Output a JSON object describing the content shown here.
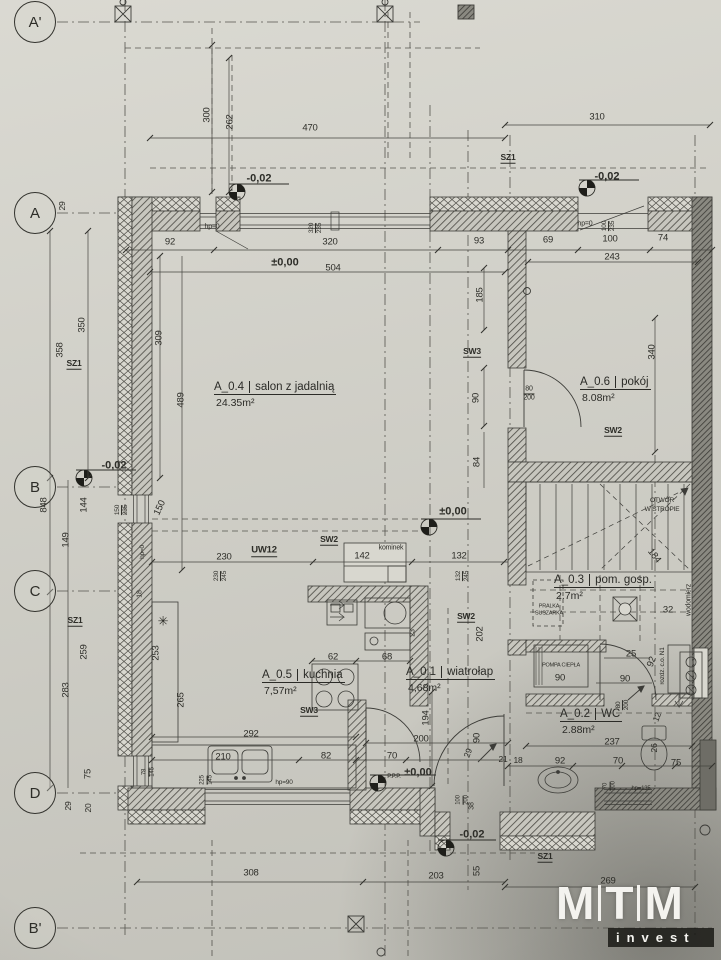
{
  "colors": {
    "paper": "#d8d7cf",
    "line": "#3c3c38",
    "dark_wall": "#6e6d66",
    "logo": "#f4f3ef"
  },
  "logo": {
    "letters": [
      "M",
      "T",
      "M"
    ],
    "sub": "invest"
  },
  "axes": [
    {
      "label": "A'",
      "x": 35,
      "y": 22
    },
    {
      "label": "A",
      "x": 35,
      "y": 213
    },
    {
      "label": "B",
      "x": 35,
      "y": 487
    },
    {
      "label": "C",
      "x": 35,
      "y": 591
    },
    {
      "label": "D",
      "x": 35,
      "y": 793
    },
    {
      "label": "B'",
      "x": 35,
      "y": 928
    }
  ],
  "rooms": [
    {
      "id": "A_0.4",
      "name": "salon z jadalnią",
      "area": "24.35m²",
      "x": 214,
      "y": 381
    },
    {
      "id": "A_0.6",
      "name": "pokój",
      "area": "8.08m²",
      "x": 580,
      "y": 376
    },
    {
      "id": "A_0.5",
      "name": "kuchnia",
      "area": "7,57m²",
      "x": 262,
      "y": 669
    },
    {
      "id": "A_0.1",
      "name": "wiatrołap",
      "area": "4,68m²",
      "x": 406,
      "y": 666
    },
    {
      "id": "A_0.3",
      "name": "pom. gosp.",
      "area": "2.7m²",
      "x": 554,
      "y": 574
    },
    {
      "id": "A_0.2",
      "name": "WC",
      "area": "2.88m²",
      "x": 560,
      "y": 708
    }
  ],
  "labels": [
    {
      "t": "300",
      "x": 207,
      "y": 115,
      "r": -90
    },
    {
      "t": "262",
      "x": 230,
      "y": 122,
      "r": -90
    },
    {
      "t": "470",
      "x": 310,
      "y": 128
    },
    {
      "t": "310",
      "x": 597,
      "y": 117
    },
    {
      "t": "SZ1",
      "x": 508,
      "y": 158,
      "u": 1
    },
    {
      "t": "-0,02",
      "x": 259,
      "y": 179,
      "b": 1,
      "n": "elevation-label"
    },
    {
      "t": "-0,02",
      "x": 607,
      "y": 177,
      "b": 1,
      "n": "elevation-label"
    },
    {
      "t": "hp=0",
      "x": 212,
      "y": 227,
      "s": 7
    },
    {
      "t": "320",
      "t2": "235",
      "x": 316,
      "y": 228,
      "r": -90
    },
    {
      "t": "hp=0",
      "x": 585,
      "y": 224,
      "s": 7
    },
    {
      "t": "100",
      "t2": "235",
      "x": 609,
      "y": 226,
      "r": -90
    },
    {
      "t": "92",
      "x": 170,
      "y": 242
    },
    {
      "t": "320",
      "x": 330,
      "y": 242
    },
    {
      "t": "93",
      "x": 479,
      "y": 241
    },
    {
      "t": "69",
      "x": 548,
      "y": 240
    },
    {
      "t": "100",
      "x": 610,
      "y": 239
    },
    {
      "t": "74",
      "x": 663,
      "y": 238
    },
    {
      "t": "±0,00",
      "x": 285,
      "y": 263,
      "b": 1,
      "n": "elevation-label"
    },
    {
      "t": "504",
      "x": 333,
      "y": 268
    },
    {
      "t": "243",
      "x": 612,
      "y": 257
    },
    {
      "t": "185",
      "x": 480,
      "y": 295,
      "r": -90
    },
    {
      "t": "29",
      "x": 62,
      "y": 206,
      "r": -90,
      "s": 8.5
    },
    {
      "t": "350",
      "x": 82,
      "y": 325,
      "r": -90
    },
    {
      "t": "358",
      "x": 60,
      "y": 350,
      "r": -90
    },
    {
      "t": "SZ1",
      "x": 74,
      "y": 364,
      "u": 1
    },
    {
      "t": "309",
      "x": 159,
      "y": 338,
      "r": -90
    },
    {
      "t": "489",
      "x": 181,
      "y": 400,
      "r": -90
    },
    {
      "t": "SW3",
      "x": 472,
      "y": 352,
      "u": 1
    },
    {
      "t": "80",
      "t2": "200",
      "x": 529,
      "y": 394,
      "s": 7
    },
    {
      "t": "90",
      "x": 476,
      "y": 398,
      "r": -90
    },
    {
      "t": "84",
      "x": 477,
      "y": 462,
      "r": -90
    },
    {
      "t": "340",
      "x": 652,
      "y": 352,
      "r": -90
    },
    {
      "t": "SW2",
      "x": 613,
      "y": 431,
      "u": 1
    },
    {
      "t": "OTWÓR",
      "x": 662,
      "y": 501,
      "s": 6.5
    },
    {
      "t": "W STROPIE",
      "x": 662,
      "y": 510,
      "s": 6.5
    },
    {
      "t": "-0,02",
      "x": 114,
      "y": 466,
      "b": 1,
      "n": "elevation-label"
    },
    {
      "t": "848",
      "x": 44,
      "y": 505,
      "r": -90
    },
    {
      "t": "144",
      "x": 84,
      "y": 505,
      "r": -90
    },
    {
      "t": "149",
      "x": 66,
      "y": 540,
      "r": -90
    },
    {
      "t": "150",
      "t2": "235",
      "x": 122,
      "y": 510,
      "r": -90
    },
    {
      "t": "150",
      "x": 160,
      "y": 508,
      "r": -65
    },
    {
      "t": "hp=0",
      "x": 143,
      "y": 552,
      "s": 6.5,
      "r": -90
    },
    {
      "t": "±0,00",
      "x": 453,
      "y": 512,
      "b": 1,
      "n": "elevation-label"
    },
    {
      "t": "230",
      "x": 224,
      "y": 557
    },
    {
      "t": "UW12",
      "x": 264,
      "y": 551,
      "u": 1,
      "s": 9.5
    },
    {
      "t": "SW2",
      "x": 329,
      "y": 540,
      "u": 1
    },
    {
      "t": "142",
      "x": 362,
      "y": 556
    },
    {
      "t": "kominek",
      "x": 391,
      "y": 548,
      "s": 7
    },
    {
      "t": "132",
      "x": 459,
      "y": 556
    },
    {
      "t": "230",
      "t2": "245",
      "x": 221,
      "y": 576,
      "r": -90
    },
    {
      "t": "132",
      "t2": "245",
      "x": 463,
      "y": 576,
      "r": -90
    },
    {
      "t": "184",
      "x": 654,
      "y": 556,
      "r": 52
    },
    {
      "t": "PRALKA",
      "x": 549,
      "y": 607,
      "s": 5.5
    },
    {
      "t": "SUSZARKA",
      "x": 549,
      "y": 614,
      "s": 5.5
    },
    {
      "t": "32",
      "x": 668,
      "y": 610
    },
    {
      "t": "wodomierz",
      "x": 689,
      "y": 600,
      "r": -90,
      "s": 7
    },
    {
      "t": "SW2",
      "x": 466,
      "y": 617,
      "u": 1
    },
    {
      "t": "202",
      "x": 480,
      "y": 634,
      "r": -90
    },
    {
      "t": "SZ1",
      "x": 75,
      "y": 621,
      "u": 1
    },
    {
      "t": "✳",
      "x": 163,
      "y": 621,
      "s": 13,
      "n": "symbol-mark"
    },
    {
      "t": "18",
      "x": 140,
      "y": 594,
      "r": -90,
      "s": 7
    },
    {
      "t": "253",
      "x": 156,
      "y": 653,
      "r": -90
    },
    {
      "t": "265",
      "x": 181,
      "y": 700,
      "r": -90
    },
    {
      "t": "259",
      "x": 84,
      "y": 652,
      "r": -90
    },
    {
      "t": "283",
      "x": 66,
      "y": 690,
      "r": -90
    },
    {
      "t": "62",
      "x": 333,
      "y": 657
    },
    {
      "t": "68",
      "x": 387,
      "y": 657
    },
    {
      "t": "SW3",
      "x": 309,
      "y": 711,
      "u": 1
    },
    {
      "t": "292",
      "x": 251,
      "y": 734
    },
    {
      "t": "210",
      "x": 223,
      "y": 757
    },
    {
      "t": "225",
      "t2": "145",
      "x": 207,
      "y": 780,
      "r": -90,
      "s": 6
    },
    {
      "t": "hp=90",
      "x": 284,
      "y": 783,
      "s": 6.5
    },
    {
      "t": "82",
      "x": 326,
      "y": 756
    },
    {
      "t": "70",
      "x": 392,
      "y": 756
    },
    {
      "t": "78",
      "t2": "145",
      "x": 149,
      "y": 772,
      "r": -90,
      "s": 6
    },
    {
      "t": "P.P.P.",
      "x": 394,
      "y": 777,
      "s": 6
    },
    {
      "t": "±0,00",
      "x": 418,
      "y": 773,
      "b": 1,
      "n": "elevation-label"
    },
    {
      "t": "75",
      "x": 88,
      "y": 774,
      "r": -90
    },
    {
      "t": "29",
      "x": 68,
      "y": 806,
      "r": -90,
      "s": 8.5
    },
    {
      "t": "20",
      "x": 88,
      "y": 808,
      "r": -90,
      "s": 8.5
    },
    {
      "t": "23",
      "x": 413,
      "y": 633,
      "r": -90,
      "s": 7
    },
    {
      "t": "194",
      "x": 426,
      "y": 718,
      "r": -90
    },
    {
      "t": "200",
      "x": 421,
      "y": 739
    },
    {
      "t": "90",
      "x": 477,
      "y": 738,
      "r": -90
    },
    {
      "t": "29",
      "x": 468,
      "y": 753,
      "r": -70,
      "s": 8.5
    },
    {
      "t": "21",
      "x": 503,
      "y": 759,
      "s": 8.5
    },
    {
      "t": "18",
      "x": 518,
      "y": 760,
      "s": 8.5
    },
    {
      "t": "POMPA CIEPŁA",
      "x": 561,
      "y": 666,
      "s": 5.5
    },
    {
      "t": "90",
      "x": 560,
      "y": 678
    },
    {
      "t": "25",
      "x": 631,
      "y": 654
    },
    {
      "t": "90",
      "x": 625,
      "y": 679
    },
    {
      "t": "92",
      "x": 652,
      "y": 662,
      "r": -70
    },
    {
      "t": "rozdz. c.o. N1",
      "x": 663,
      "y": 666,
      "r": -90,
      "s": 6.5
    },
    {
      "t": "80",
      "t2": "200",
      "x": 623,
      "y": 705,
      "r": -90
    },
    {
      "t": "12",
      "x": 657,
      "y": 717,
      "r": -70,
      "s": 8.5
    },
    {
      "t": "237",
      "x": 612,
      "y": 742
    },
    {
      "t": "26",
      "x": 654,
      "y": 748,
      "r": -90,
      "s": 8.5
    },
    {
      "t": "92",
      "x": 560,
      "y": 761
    },
    {
      "t": "70",
      "x": 618,
      "y": 761
    },
    {
      "t": "75",
      "x": 676,
      "y": 763
    },
    {
      "t": "70",
      "t2": "100",
      "x": 610,
      "y": 786,
      "r": -90,
      "s": 6
    },
    {
      "t": "hp=135",
      "x": 641,
      "y": 789,
      "s": 6
    },
    {
      "t": "38",
      "x": 472,
      "y": 806,
      "r": -90,
      "s": 7
    },
    {
      "t": "100",
      "t2": "200",
      "x": 463,
      "y": 800,
      "r": -90,
      "s": 6
    },
    {
      "t": "SZ1",
      "x": 545,
      "y": 857,
      "u": 1
    },
    {
      "t": "-0,02",
      "x": 472,
      "y": 835,
      "b": 1,
      "n": "elevation-label"
    },
    {
      "t": "55",
      "x": 477,
      "y": 871,
      "r": -90
    },
    {
      "t": "203",
      "x": 436,
      "y": 876
    },
    {
      "t": "308",
      "x": 251,
      "y": 873
    },
    {
      "t": "269",
      "x": 608,
      "y": 881
    }
  ]
}
